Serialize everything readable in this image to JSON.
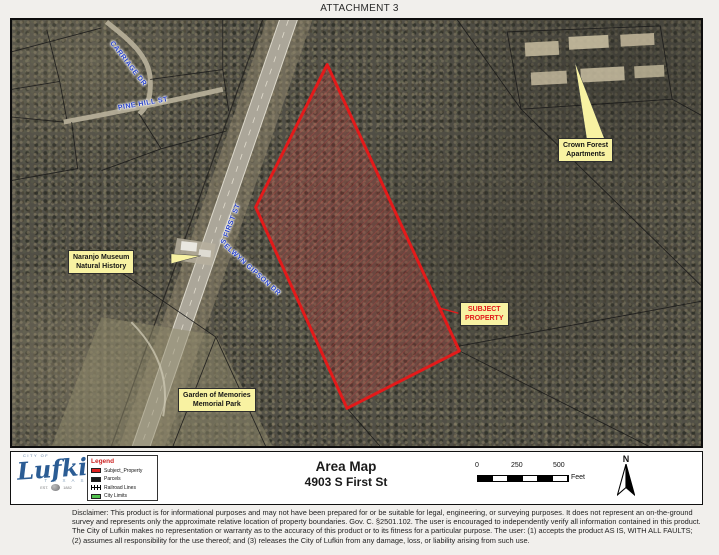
{
  "page": {
    "attachment_label": "ATTACHMENT 3"
  },
  "map": {
    "street_labels": [
      {
        "id": "carriage-dr",
        "text": "CARRIAGE DR"
      },
      {
        "id": "pine-hill-st",
        "text": "PINE HILL ST"
      },
      {
        "id": "s-first-st",
        "text": "S FIRST ST"
      },
      {
        "id": "elwyn-gipson-dr",
        "text": "ELWYN GIPSON DR"
      }
    ],
    "callouts": [
      {
        "id": "naranjo-museum",
        "line1": "Naranjo Museum",
        "line2": "Natural History"
      },
      {
        "id": "crown-forest",
        "line1": "Crown Forest",
        "line2": "Apartments"
      },
      {
        "id": "subject-property",
        "line1": "SUBJECT",
        "line2": "PROPERTY"
      },
      {
        "id": "garden-memories",
        "line1": "Garden of Memories",
        "line2": "Memorial Park"
      }
    ],
    "subject_outline_color": "#e31a1a"
  },
  "footer": {
    "logo": {
      "city_of": "CITY OF",
      "name": "Lufkin",
      "state": "T E X A S",
      "est_left": "EST.",
      "est_right": "1882"
    },
    "legend": {
      "title": "Legend",
      "items": [
        {
          "label": "Subject_Property",
          "color": "#e02020",
          "swatch": "box"
        },
        {
          "label": "Parcels",
          "color": "#1a1a1a",
          "swatch": "box"
        },
        {
          "label": "Railroad Lines",
          "color": "#000000",
          "swatch": "line"
        },
        {
          "label": "City Limits",
          "color": "#52c24e",
          "swatch": "box"
        }
      ]
    },
    "title_line1": "Area Map",
    "title_line2": "4903 S First St",
    "scalebar": {
      "tick0": "0",
      "tick1": "250",
      "tick2": "500",
      "unit": "Feet"
    },
    "north_label": "N"
  },
  "disclaimer": {
    "lines": [
      "Disclaimer: This product is for informational purposes and may not have been prepared for or be suitable for legal, engineering, or surveying purposes. It does not represent an on-the-ground",
      "survey and represents only the approximate relative location of property boundaries. Gov. C. §2501.102. The user is encouraged to independently verify all information contained in this product.",
      "The City of Lufkin makes no representation or warranty as to the accuracy of this product or to its fitness for a particular purpose. The user: (1) accepts the product AS IS, WITH ALL FAULTS;",
      "(2) assumes all responsibility for the use thereof; and (3) releases the City of Lufkin from any damage, loss, or liability arising from such use."
    ]
  }
}
